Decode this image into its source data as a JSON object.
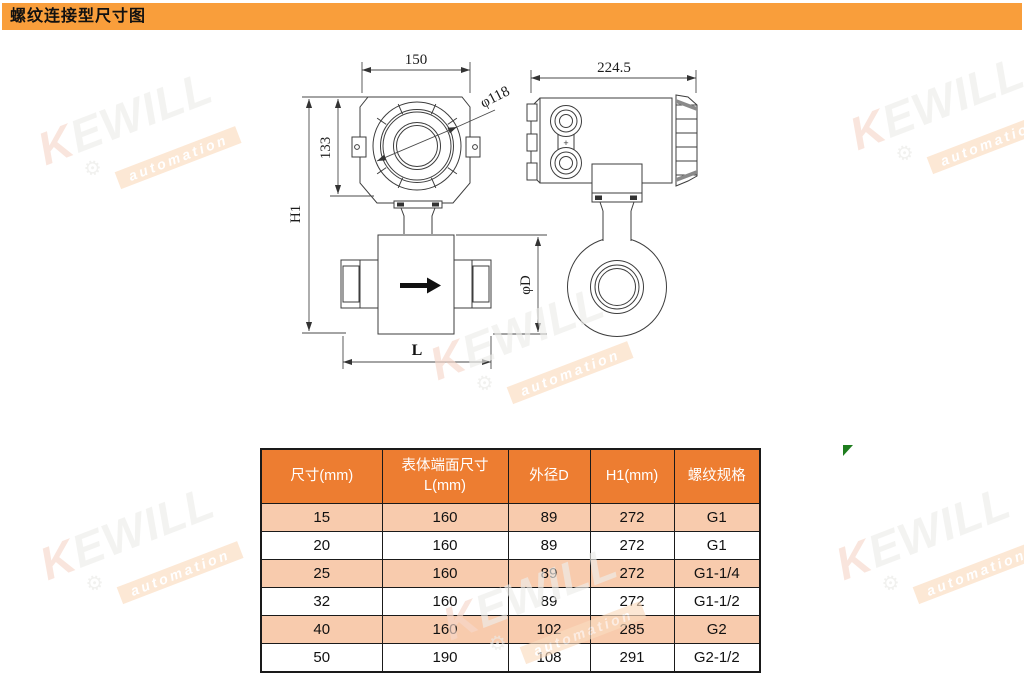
{
  "page": {
    "title": "螺纹连接型尺寸图"
  },
  "colors": {
    "title_bar": "#F99E3B",
    "table_header_bg": "#ED7D31",
    "table_row_alt_bg": "#F8CBAD",
    "drawing_line": "#3d3d3d",
    "green_mark": "#1e7d1e"
  },
  "watermark": {
    "brand": "KEWILL",
    "tagline": "automation"
  },
  "drawing": {
    "labels": {
      "front_width": "150",
      "side_width": "224.5",
      "bezel_diameter": "φ118",
      "head_height": "133",
      "total_height": "H1",
      "body_diameter": "φD",
      "body_length": "L",
      "gland_plus": "+"
    }
  },
  "table": {
    "headers": {
      "size": "尺寸(mm)",
      "face_l1": "表体端面尺寸",
      "face_l2": "L(mm)",
      "outer_d": "外径D",
      "h1": "H1(mm)",
      "thread": "螺纹规格"
    },
    "rows": [
      [
        "15",
        "160",
        "89",
        "272",
        "G1"
      ],
      [
        "20",
        "160",
        "89",
        "272",
        "G1"
      ],
      [
        "25",
        "160",
        "89",
        "272",
        "G1-1/4"
      ],
      [
        "32",
        "160",
        "89",
        "272",
        "G1-1/2"
      ],
      [
        "40",
        "160",
        "102",
        "285",
        "G2"
      ],
      [
        "50",
        "190",
        "108",
        "291",
        "G2-1/2"
      ]
    ]
  }
}
